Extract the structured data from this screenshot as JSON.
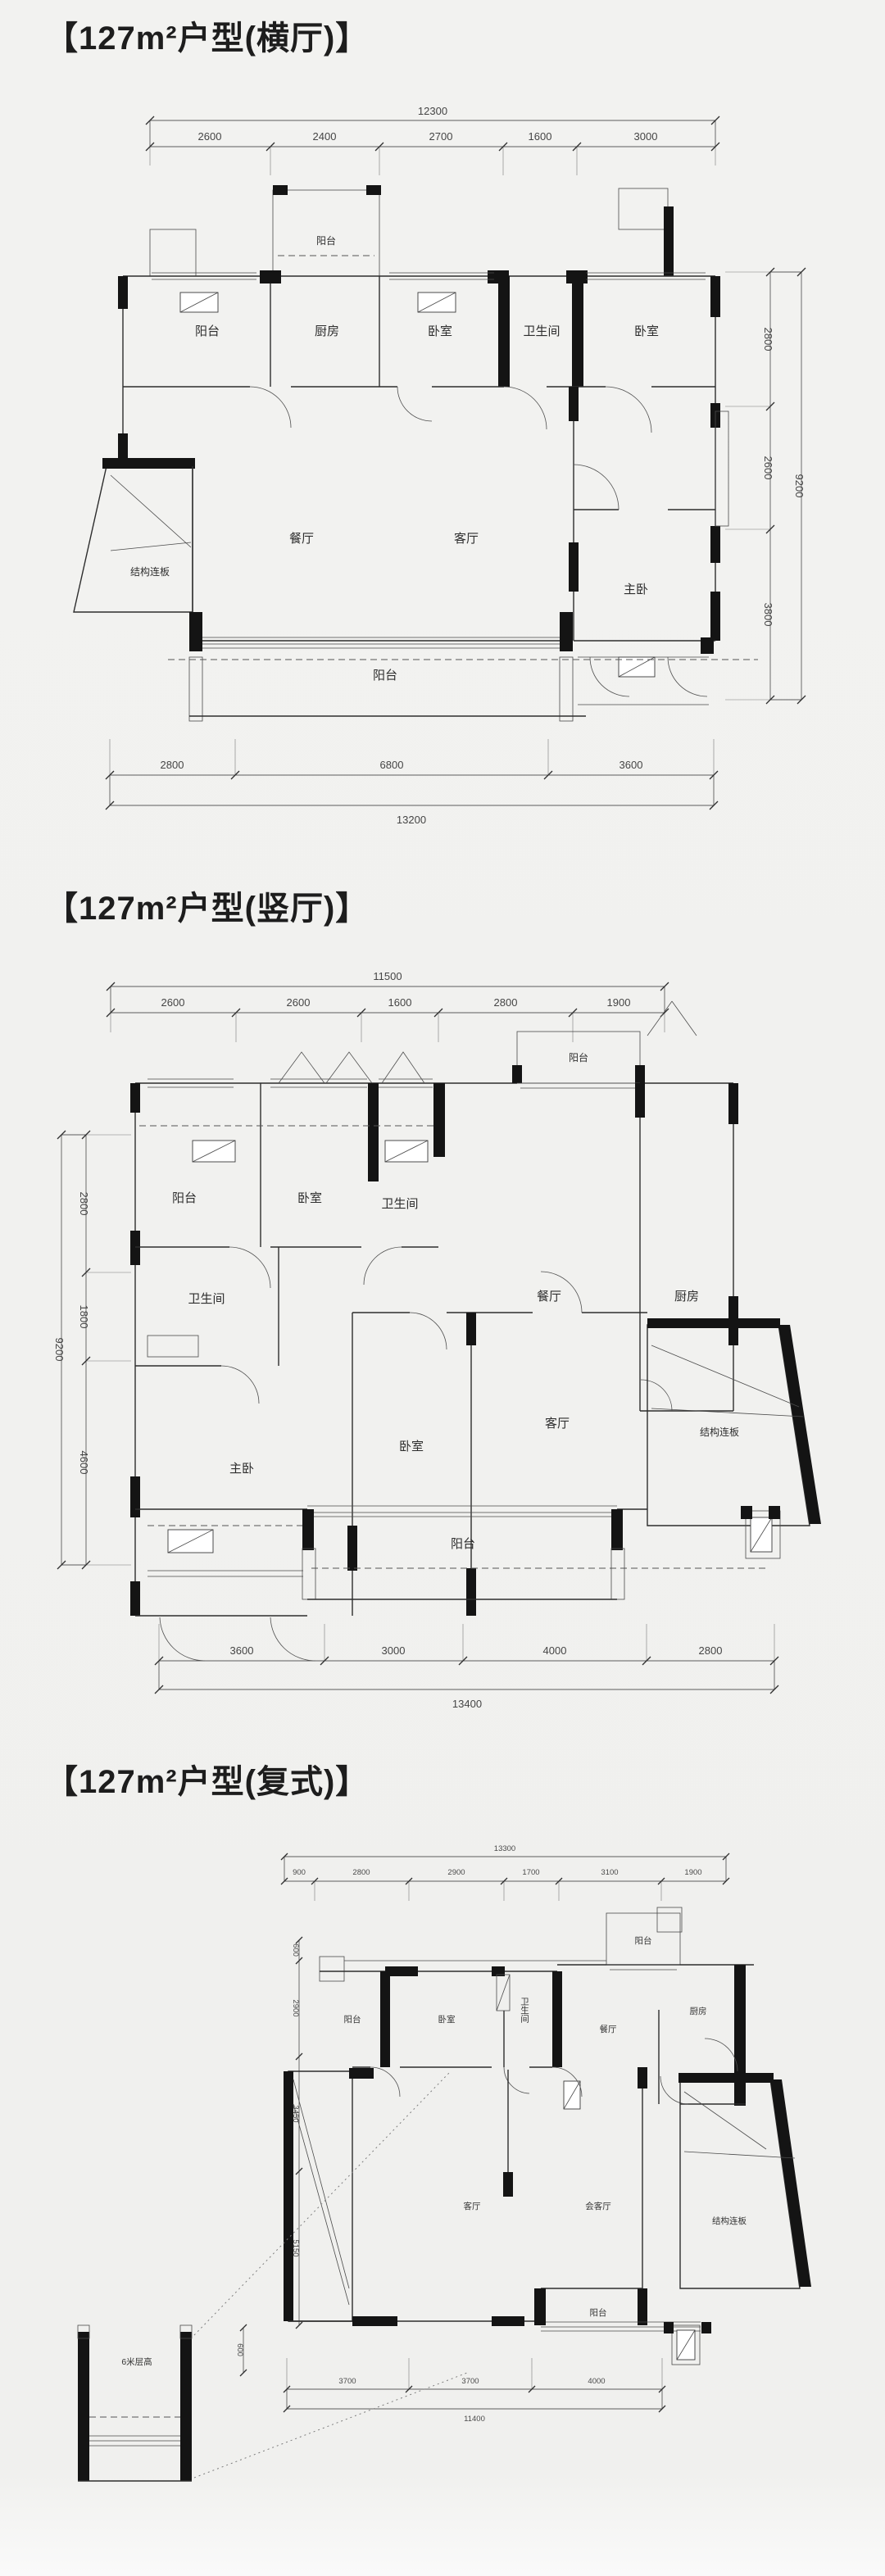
{
  "sections": [
    {
      "id": "hengting",
      "title": "【127m²户型(横厅)】",
      "rooms": {
        "balcony_top_left": "阳台",
        "balcony_top_small": "阳台",
        "kitchen": "厨房",
        "bedroom_1": "卧室",
        "bathroom": "卫生间",
        "bedroom_2": "卧室",
        "dining": "餐厅",
        "living": "客厅",
        "master": "主卧",
        "slab": "结构连板",
        "balcony_bottom": "阳台"
      },
      "dims": {
        "top_total": "12300",
        "top_segments": [
          "2600",
          "2400",
          "2700",
          "1600",
          "3000"
        ],
        "right_segments": [
          "2800",
          "2600",
          "3800"
        ],
        "right_total": "9200",
        "bottom_segments": [
          "2800",
          "6800",
          "3600"
        ],
        "bottom_total": "13200"
      }
    },
    {
      "id": "shuting",
      "title": "【127m²户型(竖厅)】",
      "rooms": {
        "balcony_left": "阳台",
        "bedroom_1": "卧室",
        "bathroom_1": "卫生间",
        "balcony_top": "阳台",
        "dining": "餐厅",
        "kitchen": "厨房",
        "bathroom_2": "卫生间",
        "master": "主卧",
        "bedroom_2": "卧室",
        "living": "客厅",
        "slab": "结构连板",
        "balcony_bottom": "阳台"
      },
      "dims": {
        "top_total": "11500",
        "top_segments": [
          "2600",
          "2600",
          "1600",
          "2800",
          "1900"
        ],
        "left_segments": [
          "2800",
          "1800",
          "4600"
        ],
        "left_total": "9200",
        "bottom_segments": [
          "3600",
          "3000",
          "4000",
          "2800"
        ],
        "bottom_total": "13400"
      }
    },
    {
      "id": "fushi",
      "title": "【127m²户型(复式)】",
      "rooms": {
        "balcony_top": "阳台",
        "balcony_left": "阳台",
        "bedroom": "卧室",
        "bathroom": "卫生间",
        "dining": "餐厅",
        "kitchen": "厨房",
        "living": "客厅",
        "reception": "会客厅",
        "slab": "结构连板",
        "balcony_bottom": "阳台",
        "void_note": "6米层高"
      },
      "dims": {
        "top_total": "13300",
        "top_segments": [
          "900",
          "2800",
          "2900",
          "1700",
          "3100",
          "1900"
        ],
        "left_segments": [
          "600",
          "2900",
          "3450",
          "5150"
        ],
        "left_small": "600",
        "bottom_segments": [
          "3700",
          "3700",
          "4000"
        ],
        "bottom_total": "11400"
      }
    }
  ]
}
